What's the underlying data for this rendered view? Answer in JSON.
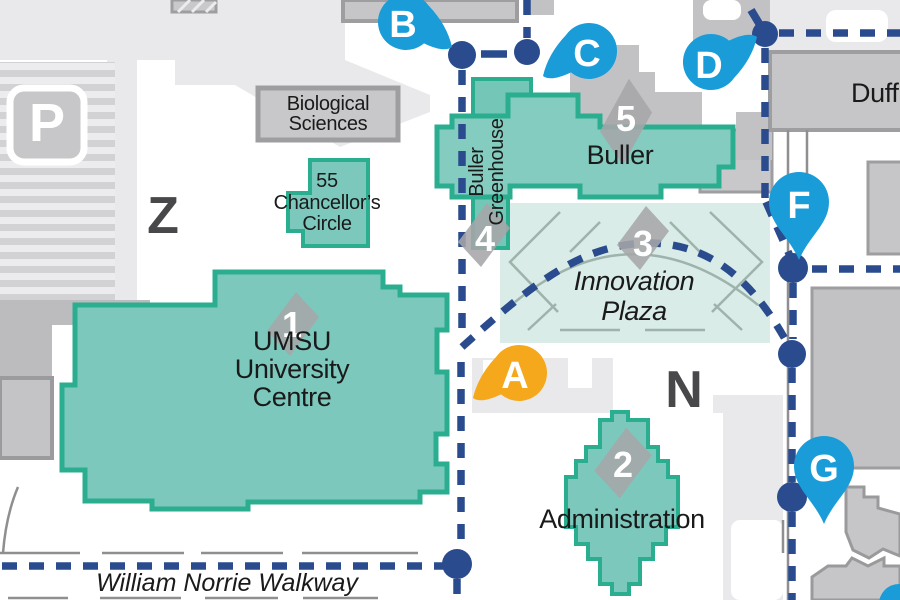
{
  "colors": {
    "teal_fill": "#7CC8BC",
    "teal_stroke": "#2AAE8F",
    "plaza_fill": "#D9ECE7",
    "gray_building": "#C6C6C8",
    "gray_border": "#9E9EA0",
    "ground": "#E9E9EB",
    "path_navy": "#2A4B8D",
    "pin_blue": "#199CD8",
    "pin_orange": "#F5A81C",
    "marker_gray": "#A6A6A8",
    "text_dark": "#1A1A1A",
    "zone_letter": "#48484A"
  },
  "zones": {
    "z": "Z",
    "n": "N"
  },
  "parking": {
    "symbol": "P"
  },
  "buildings": {
    "umsu": {
      "marker": "1",
      "line1": "UMSU",
      "line2": "University",
      "line3": "Centre"
    },
    "administration": {
      "marker": "2",
      "name": "Administration"
    },
    "buller": {
      "marker": "5",
      "name": "Buller"
    },
    "buller_greenhouse": {
      "marker": "4",
      "line1": "Buller",
      "line2": "Greenhouse"
    },
    "chancellors_circle": {
      "line1": "55",
      "line2": "Chancellor’s",
      "line3": "Circle"
    },
    "biological_sciences": {
      "line1": "Biological",
      "line2": "Sciences"
    },
    "duff": {
      "name": "Duff"
    }
  },
  "plaza": {
    "marker": "3",
    "line1": "Innovation",
    "line2": "Plaza"
  },
  "walkway": {
    "name": "William Norrie Walkway"
  },
  "pins": {
    "a": "A",
    "b": "B",
    "c": "C",
    "d": "D",
    "f": "F",
    "g": "G"
  }
}
